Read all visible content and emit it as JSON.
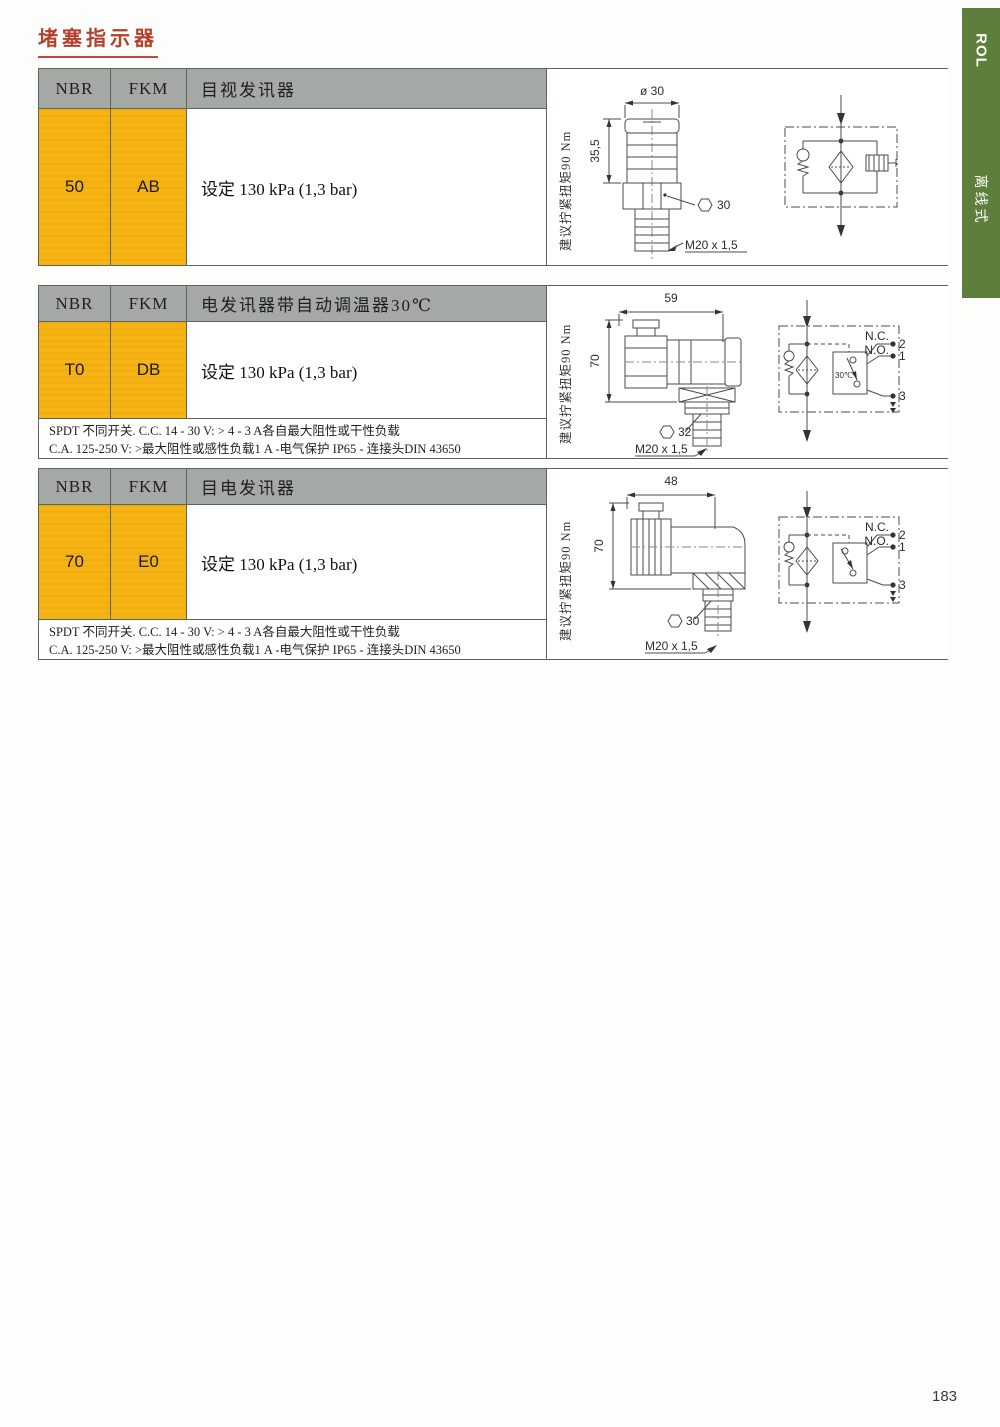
{
  "page": {
    "title": "堵塞指示器",
    "page_number": "183",
    "side_tab": {
      "code": "ROL",
      "category": "离线式"
    }
  },
  "colors": {
    "accent_yellow": "#f5b314",
    "header_gray": "#a5a9a6",
    "tab_green": "#5e7f3c",
    "title_red": "#b4402c"
  },
  "blocks": [
    {
      "header": {
        "col1": "NBR",
        "col2": "FKM",
        "title": "目视发讯器"
      },
      "row": {
        "nbr": "50",
        "fkm": "AB",
        "desc": "设定 130 kPa (1,3 bar)"
      },
      "torque_note": "建议拧紧扭矩90 Nm",
      "drawing": {
        "dim_top": "ø 30",
        "dim_left": "35,5",
        "dim_hex": "30",
        "dim_thread": "M20 x 1,5"
      }
    },
    {
      "header": {
        "col1": "NBR",
        "col2": "FKM",
        "title": "电发讯器带自动调温器30℃"
      },
      "row": {
        "nbr": "T0",
        "fkm": "DB",
        "desc": "设定 130 kPa (1,3 bar)"
      },
      "footer_line1": "SPDT 不同开关. C.C. 14 - 30 V: > 4 - 3 A各自最大阻性或干性负载",
      "footer_line2": "C.A. 125-250 V: >最大阻性或感性负载1 A -电气保护 IP65 - 连接头DIN 43650",
      "torque_note": "建议拧紧扭矩90 Nm",
      "drawing": {
        "dim_top": "59",
        "dim_left": "70",
        "dim_hex": "32",
        "dim_thread": "M20 x 1,5"
      },
      "schematic": {
        "thermostat": "30℃",
        "nc": "N.C.",
        "no": "N.O.",
        "t2": "2",
        "t1": "1",
        "t3": "3"
      }
    },
    {
      "header": {
        "col1": "NBR",
        "col2": "FKM",
        "title": "目电发讯器"
      },
      "row": {
        "nbr": "70",
        "fkm": "E0",
        "desc": "设定 130 kPa (1,3 bar)"
      },
      "footer_line1": "SPDT 不同开关. C.C. 14 - 30 V: > 4 - 3 A各自最大阻性或干性负载",
      "footer_line2": "C.A. 125-250 V: >最大阻性或感性负载1 A -电气保护 IP65 - 连接头DIN 43650",
      "torque_note": "建议拧紧扭矩90 Nm",
      "drawing": {
        "dim_top": "48",
        "dim_left": "70",
        "dim_hex": "30",
        "dim_thread": "M20 x 1,5"
      },
      "schematic": {
        "nc": "N.C.",
        "no": "N.O.",
        "t2": "2",
        "t1": "1",
        "t3": "3"
      }
    }
  ]
}
